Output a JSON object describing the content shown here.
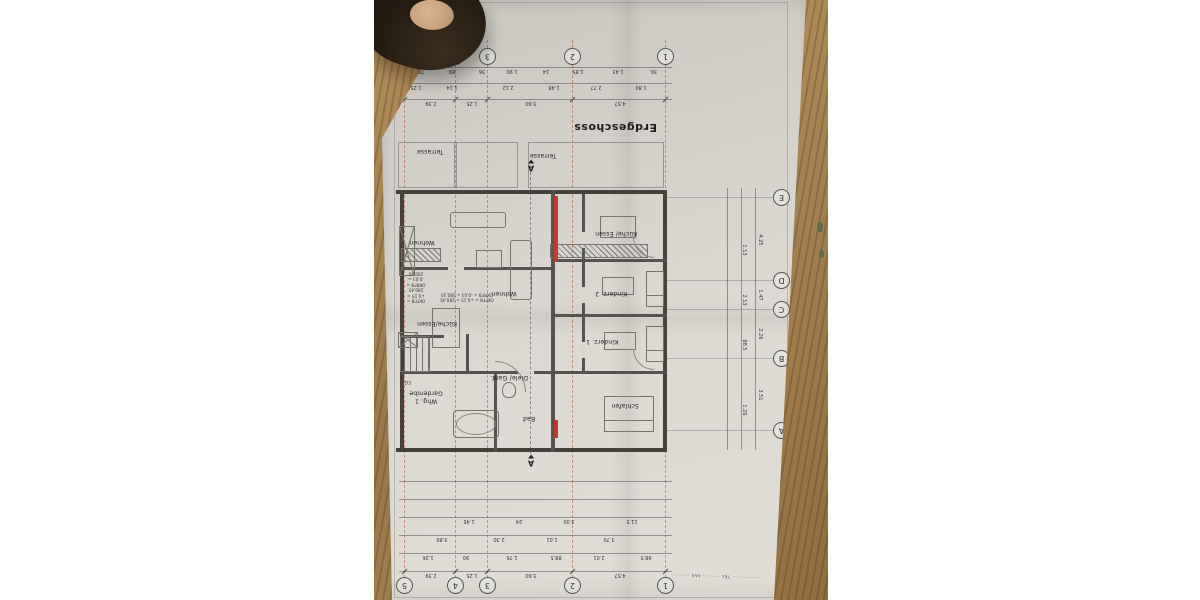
{
  "plan": {
    "title": "Erdgeschoss",
    "fine_print": "·· ········ ····· TEL ········ · FAX ········ ··",
    "stair_label": "EG",
    "grid_cols": [
      {
        "label": "1",
        "x": 138
      },
      {
        "label": "2",
        "x": 231
      },
      {
        "label": "3",
        "x": 316
      },
      {
        "label": "4",
        "x": 348
      },
      {
        "label": "5",
        "x": 399
      }
    ],
    "grid_rows": [
      {
        "label": "A",
        "y": 169
      },
      {
        "label": "B",
        "y": 241
      },
      {
        "label": "C",
        "y": 290
      },
      {
        "label": "D",
        "y": 319
      },
      {
        "label": "E",
        "y": 402
      }
    ],
    "row_span_dims": [
      {
        "v": "3.51",
        "y": 205
      },
      {
        "v": "2.26",
        "y": 266
      },
      {
        "v": "1.47",
        "y": 305
      },
      {
        "v": "4.25",
        "y": 360
      }
    ],
    "inner_row_dims": [
      {
        "v": "1.26",
        "y": 190
      },
      {
        "v": "88.5",
        "y": 255
      },
      {
        "v": "2.13",
        "y": 300
      },
      {
        "v": "1.13",
        "y": 350
      }
    ],
    "dim_rows_top": [
      {
        "y": 28,
        "numbers": [
          {
            "v": "4.57",
            "x": 184
          },
          {
            "v": "3.60",
            "x": 273
          },
          {
            "v": "1.25",
            "x": 332
          },
          {
            "v": "2.39",
            "x": 373
          }
        ]
      },
      {
        "y": 46,
        "numbers": [
          {
            "v": "98.5",
            "x": 158
          },
          {
            "v": "2.01",
            "x": 205
          },
          {
            "v": "88.5",
            "x": 248
          },
          {
            "v": "1.76",
            "x": 292
          },
          {
            "v": "90",
            "x": 338
          },
          {
            "v": "1.26",
            "x": 376
          }
        ]
      },
      {
        "y": 64,
        "numbers": [
          {
            "v": "3.70",
            "x": 195
          },
          {
            "v": "1.01",
            "x": 252
          },
          {
            "v": "2.30",
            "x": 305
          },
          {
            "v": "3.80",
            "x": 362
          }
        ]
      },
      {
        "y": 82,
        "numbers": [
          {
            "v": "11.5",
            "x": 172
          },
          {
            "v": "3.00",
            "x": 235
          },
          {
            "v": "24",
            "x": 285
          },
          {
            "v": "1.45",
            "x": 335
          }
        ]
      },
      {
        "y": 100,
        "numbers": []
      },
      {
        "y": 118,
        "numbers": []
      }
    ],
    "dim_rows_bottom": [
      {
        "y": 500,
        "numbers": [
          {
            "v": "4.57",
            "x": 184
          },
          {
            "v": "3.60",
            "x": 273
          },
          {
            "v": "1.25",
            "x": 332
          },
          {
            "v": "2.39",
            "x": 373
          }
        ]
      },
      {
        "y": 516,
        "numbers": [
          {
            "v": "1.80",
            "x": 163
          },
          {
            "v": "2.77",
            "x": 208
          },
          {
            "v": "1.48",
            "x": 250
          },
          {
            "v": "2.12",
            "x": 296
          },
          {
            "v": "1.14",
            "x": 352
          },
          {
            "v": "1.25",
            "x": 388
          }
        ]
      },
      {
        "y": 532,
        "numbers": [
          {
            "v": "36",
            "x": 150
          },
          {
            "v": "1.43",
            "x": 186
          },
          {
            "v": "1.85",
            "x": 226
          },
          {
            "v": "14",
            "x": 258
          },
          {
            "v": "1.90",
            "x": 292
          },
          {
            "v": "36",
            "x": 322
          },
          {
            "v": "89",
            "x": 352
          },
          {
            "v": "76",
            "x": 383
          }
        ]
      }
    ],
    "rooms": [
      {
        "label": "Schlafen",
        "x": 179,
        "y": 195
      },
      {
        "label": "Kinderz. 1",
        "x": 202,
        "y": 259
      },
      {
        "label": "Kinderz. 2",
        "x": 193,
        "y": 307
      },
      {
        "label": "Küche/ Essen",
        "x": 188,
        "y": 367
      },
      {
        "label": "Bad",
        "x": 275,
        "y": 182
      },
      {
        "label": "Diele/ Gard.",
        "x": 295,
        "y": 223
      },
      {
        "label": "Whg. 1\nGarderobe",
        "x": 378,
        "y": 203
      },
      {
        "label": "Küche/Essen",
        "x": 367,
        "y": 277
      },
      {
        "label": "Wohnen",
        "x": 300,
        "y": 307
      },
      {
        "label": "Wohnen",
        "x": 382,
        "y": 358
      },
      {
        "label": "Terrasse",
        "x": 261,
        "y": 445
      },
      {
        "label": "Terrasse",
        "x": 374,
        "y": 449
      }
    ],
    "level_notes": [
      {
        "text": "OKFFB = +0,15 = 280,45\nOKRFB = -0,03 = 280,30",
        "x": 337,
        "y": 303
      },
      {
        "text": "OKFFB = +0,15 = 280,45\nOKRFB = -0,03 = 280,30",
        "x": 388,
        "y": 313
      }
    ],
    "section_marker_label": "A",
    "colors": {
      "grid_axis": "#b04a32",
      "revision_red": "#c23b2a",
      "paper": "#d8d5ce",
      "wood": "#a27c4c"
    },
    "geometry": {
      "walls_thick": [
        [
          137,
          148,
          271,
          4
        ],
        [
          137,
          406,
          271,
          4
        ],
        [
          137,
          148,
          4,
          262
        ],
        [
          400,
          148,
          4,
          262
        ]
      ],
      "walls_mid": [
        [
          249,
          148,
          4,
          262
        ],
        [
          137,
          226,
          114,
          3
        ],
        [
          137,
          283,
          114,
          3
        ],
        [
          137,
          338,
          114,
          3
        ],
        [
          219,
          226,
          3,
          180
        ],
        [
          253,
          226,
          150,
          3
        ],
        [
          307,
          148,
          3,
          80
        ],
        [
          253,
          330,
          150,
          3
        ],
        [
          335,
          226,
          3,
          40
        ],
        [
          360,
          262,
          43,
          3
        ]
      ],
      "gaps": [
        [
          219,
          242,
          3,
          16
        ],
        [
          219,
          297,
          3,
          16
        ],
        [
          219,
          352,
          3,
          16
        ],
        [
          270,
          226,
          16,
          3
        ],
        [
          340,
          330,
          16,
          3
        ]
      ],
      "furniture": [
        [
          150,
          168,
          48,
          34,
          "bed"
        ],
        [
          140,
          238,
          16,
          34,
          "bed"
        ],
        [
          140,
          293,
          16,
          34,
          "bed"
        ],
        [
          168,
          250,
          30,
          16,
          "desk"
        ],
        [
          170,
          305,
          30,
          16,
          "desk"
        ],
        [
          168,
          362,
          34,
          20,
          "desk"
        ],
        [
          305,
          162,
          44,
          26,
          "tub"
        ],
        [
          288,
          202,
          12,
          14,
          "wc"
        ],
        [
          156,
          342,
          96,
          12,
          "counter"
        ],
        [
          363,
          338,
          38,
          12,
          "counter"
        ],
        [
          272,
          300,
          20,
          58,
          "sofa"
        ],
        [
          298,
          372,
          54,
          14,
          "sofa"
        ],
        [
          302,
          332,
          24,
          16,
          "desk"
        ],
        [
          344,
          252,
          26,
          38,
          "desk"
        ],
        [
          374,
          228,
          28,
          34,
          "stairs"
        ],
        [
          389,
          324,
          14,
          48,
          "xbox"
        ],
        [
          386,
          252,
          18,
          14,
          "xbox"
        ],
        [
          246,
          338,
          4,
          66,
          "red"
        ],
        [
          246,
          162,
          4,
          18,
          "red"
        ]
      ],
      "arcs": [
        [
          278,
          208,
          30,
          "bl"
        ],
        [
          150,
          230,
          20,
          "tr"
        ],
        [
          150,
          342,
          20,
          "tr"
        ]
      ],
      "terraces": [
        [
          140,
          412,
          134,
          44
        ],
        [
          286,
          412,
          118,
          44
        ]
      ],
      "terrace_divider": [
        347,
        412,
        1,
        44
      ],
      "section_line": {
        "x": 273,
        "y1": 146,
        "y2": 428
      },
      "section_markers": [
        {
          "x": 273,
          "y": 137
        },
        {
          "x": 273,
          "y": 432
        }
      ]
    }
  }
}
